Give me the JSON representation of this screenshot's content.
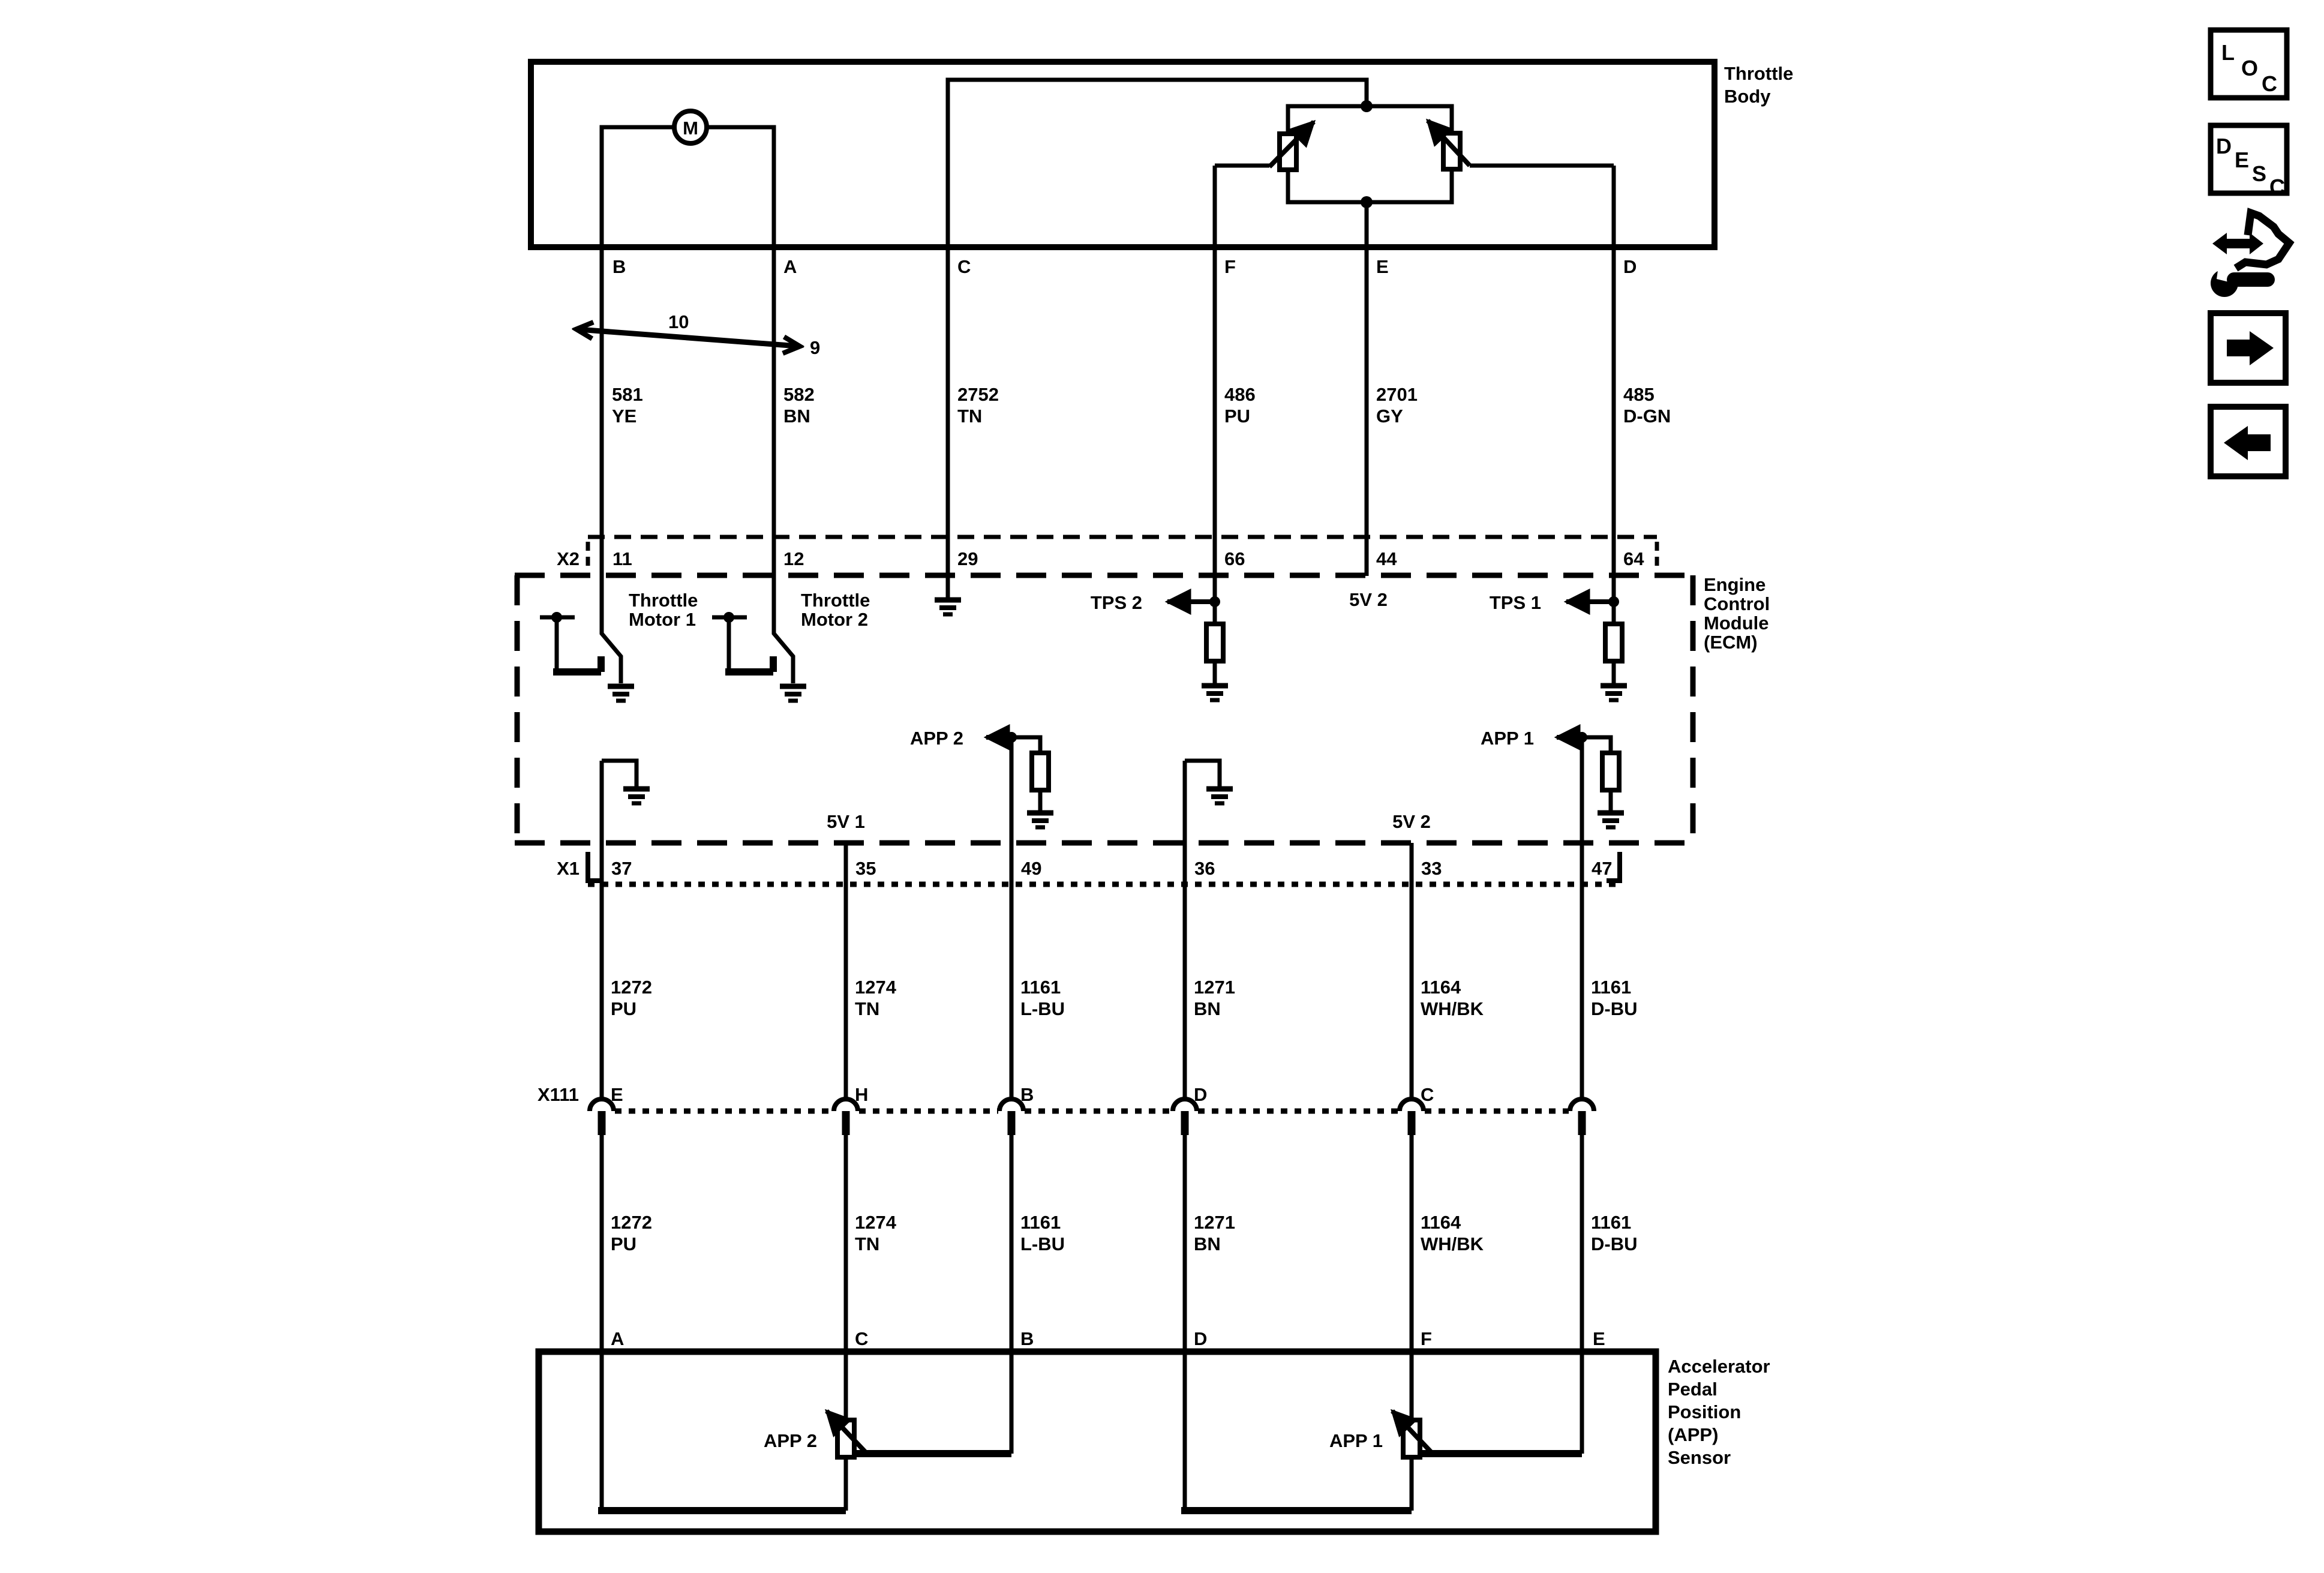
{
  "colors": {
    "ink": "#000000",
    "paper": "#ffffff"
  },
  "throttle_body": {
    "name_lines": [
      "Throttle",
      "Body"
    ],
    "motor_label": "M",
    "pins": [
      "B",
      "A",
      "C",
      "F",
      "E",
      "D"
    ]
  },
  "callout": {
    "upper": "10",
    "lower": "9"
  },
  "top_wires_l1": [
    "581",
    "582",
    "2752",
    "486",
    "2701",
    "485"
  ],
  "top_wires_l2": [
    "YE",
    "BN",
    "TN",
    "PU",
    "GY",
    "D-GN"
  ],
  "x2": {
    "name": "X2",
    "pins": [
      "11",
      "12",
      "29",
      "66",
      "44",
      "64"
    ]
  },
  "ecm": {
    "name_lines": [
      "Engine",
      "Control",
      "Module",
      "(ECM)"
    ],
    "tm1_l1": "Throttle",
    "tm1_l2": "Motor 1",
    "tm2_l1": "Throttle",
    "tm2_l2": "Motor 2",
    "tps2": "TPS 2",
    "tps1": "TPS 1",
    "v2_top": "5V 2",
    "app2": "APP 2",
    "app1": "APP 1",
    "v1": "5V 1",
    "v2_bot": "5V 2"
  },
  "x1": {
    "name": "X1",
    "pins": [
      "37",
      "35",
      "49",
      "36",
      "33",
      "47"
    ]
  },
  "mid_wires_l1": [
    "1272",
    "1274",
    "1161",
    "1271",
    "1164",
    "1161"
  ],
  "mid_wires_l2": [
    "PU",
    "TN",
    "L-BU",
    "BN",
    "WH/BK",
    "D-BU"
  ],
  "x111": {
    "name": "X111",
    "pins": [
      "E",
      "H",
      "B",
      "D",
      "C"
    ]
  },
  "low_wires_l1": [
    "1272",
    "1274",
    "1161",
    "1271",
    "1164",
    "1161"
  ],
  "low_wires_l2": [
    "PU",
    "TN",
    "L-BU",
    "BN",
    "WH/BK",
    "D-BU"
  ],
  "bottom_pins": [
    "A",
    "C",
    "B",
    "D",
    "F",
    "E"
  ],
  "app_sensor": {
    "name_lines": [
      "Accelerator",
      "Pedal",
      "Position",
      "(APP)",
      "Sensor"
    ],
    "app2": "APP 2",
    "app1": "APP 1"
  },
  "sidebar": {
    "loc_letters": [
      "L",
      "O",
      "C"
    ],
    "desc_letters": [
      "D",
      "E",
      "S",
      "C"
    ]
  }
}
